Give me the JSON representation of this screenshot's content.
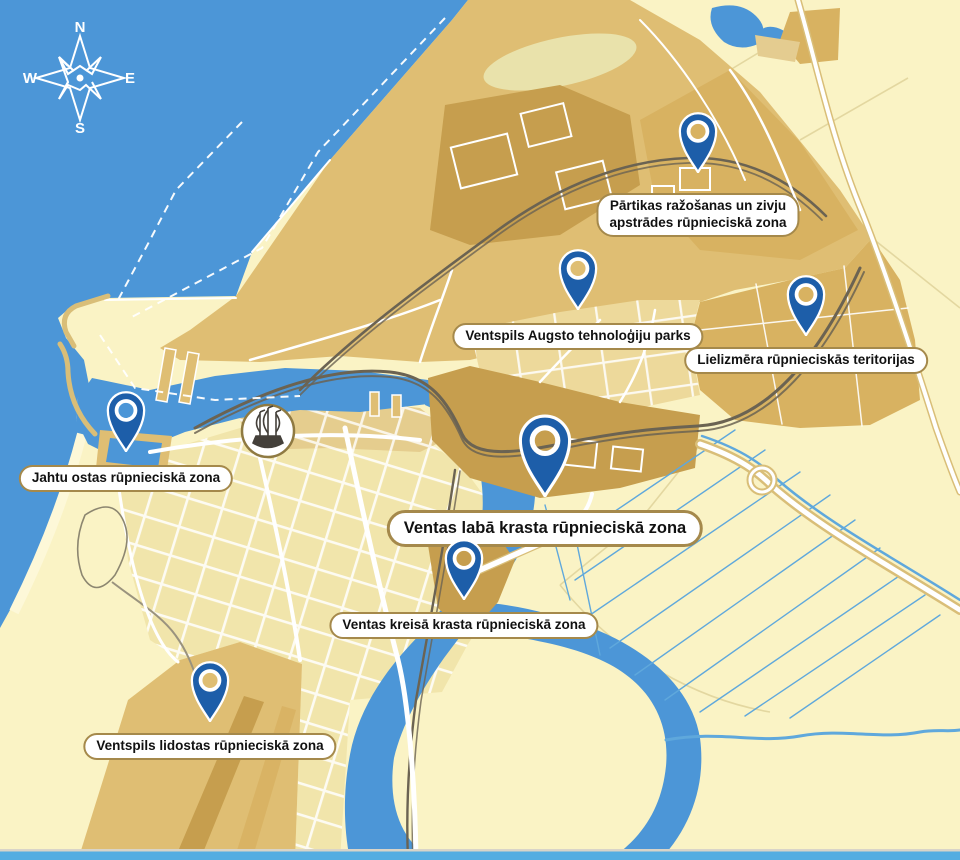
{
  "compass": {
    "north": "N",
    "east": "E",
    "south": "S",
    "west": "W"
  },
  "markers": [
    {
      "id": "partikas",
      "lines": [
        "Pārtikas ražošanas un zivju",
        "apstrādes rūpnieciskā zona"
      ]
    },
    {
      "id": "augsto",
      "lines": [
        "Ventspils Augsto tehnoloģiju parks"
      ]
    },
    {
      "id": "lielizmera",
      "lines": [
        "Lielizmēra rūpnieciskās teritorijas"
      ]
    },
    {
      "id": "jahtu-ostas",
      "lines": [
        "Jahtu ostas rūpnieciskā zona"
      ]
    },
    {
      "id": "ventas-laba",
      "lines": [
        "Ventas labā krasta rūpnieciskā zona"
      ],
      "emphasis": true
    },
    {
      "id": "ventas-kreisa",
      "lines": [
        "Ventas kreisā krasta rūpnieciskā zona"
      ]
    },
    {
      "id": "lidostas",
      "lines": [
        "Ventspils lidostas rūpnieciskā zona"
      ]
    }
  ],
  "colors": {
    "sea": "#4C96D7",
    "land": "#FAF3C5",
    "sand": "#FDF8D8",
    "port": "#DFBE73",
    "port_mid": "#D8B261",
    "port_dark": "#C69E4E",
    "city": "#F1E5AB",
    "city_dark": "#E5CD8E",
    "right_bank": "#EDD99B",
    "olive": "#E9E2AB",
    "road": "#FFFFFF",
    "road_casing": "#D9BE78",
    "railway": "#6B6352",
    "railway_light": "#9A937E",
    "ditch": "#5FA8DC",
    "pin": "#1D5EA9",
    "label_bg": "#FFFFFF",
    "label_border": "#A5894B",
    "text": "#111111",
    "bottom_bar": "#54ADE1",
    "emblem_stroke": "#8F7A42",
    "emblem_ink": "#44403A"
  }
}
